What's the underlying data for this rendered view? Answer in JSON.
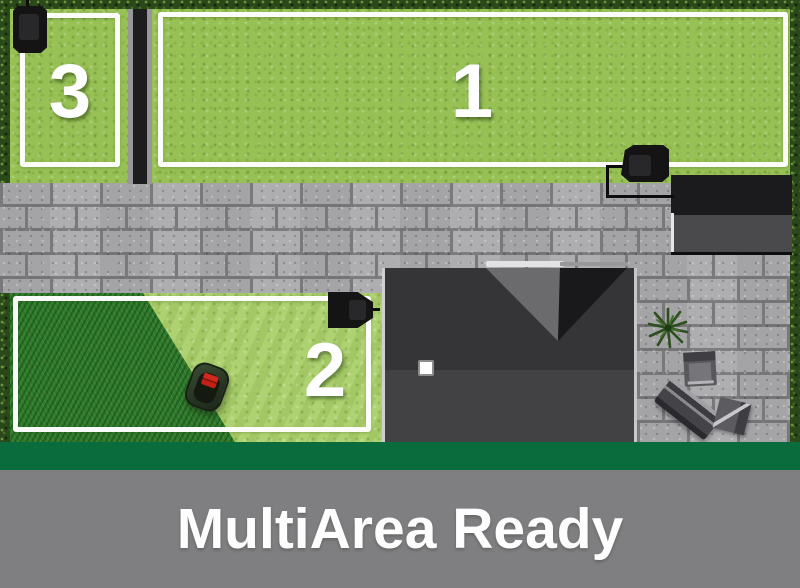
{
  "banner": {
    "title": "MultiArea Ready",
    "band_color": "#0a6b3c",
    "bar_color": "#7f7f81",
    "text_color": "#ffffff"
  },
  "scene": {
    "areas": [
      {
        "id": "lawn-area-1",
        "label": "1"
      },
      {
        "id": "lawn-area-2",
        "label": "2"
      },
      {
        "id": "lawn-area-3",
        "label": "3"
      }
    ],
    "objects": {
      "charging_stations": [
        "area-3-charging-station",
        "area-1-charging-station",
        "area-2-charging-station"
      ],
      "mower": "robotic-lawnmower",
      "boundary_wires": [
        "area-1-wire",
        "area-2-wire",
        "area-3-wire"
      ],
      "structures": [
        "house-roof",
        "garage-roof",
        "paver-path",
        "paver-patio"
      ],
      "greenery": [
        "hedge-top",
        "hedge-left",
        "hedge-right",
        "potted-plant"
      ],
      "furniture": [
        "patio-chair",
        "patio-lounger",
        "patio-chair"
      ]
    },
    "colors": {
      "lawn_light": "#97c055",
      "lawn_cut": "#a9cf68",
      "lawn_uncut": "#2e7c2a",
      "hedge": "#2b481b",
      "paver": "#a9a9ab",
      "roof_dark": "#353537",
      "roof_light": "#424245",
      "wire": "#ffffff",
      "station": "#141414",
      "mower_accent": "#c42018"
    }
  }
}
